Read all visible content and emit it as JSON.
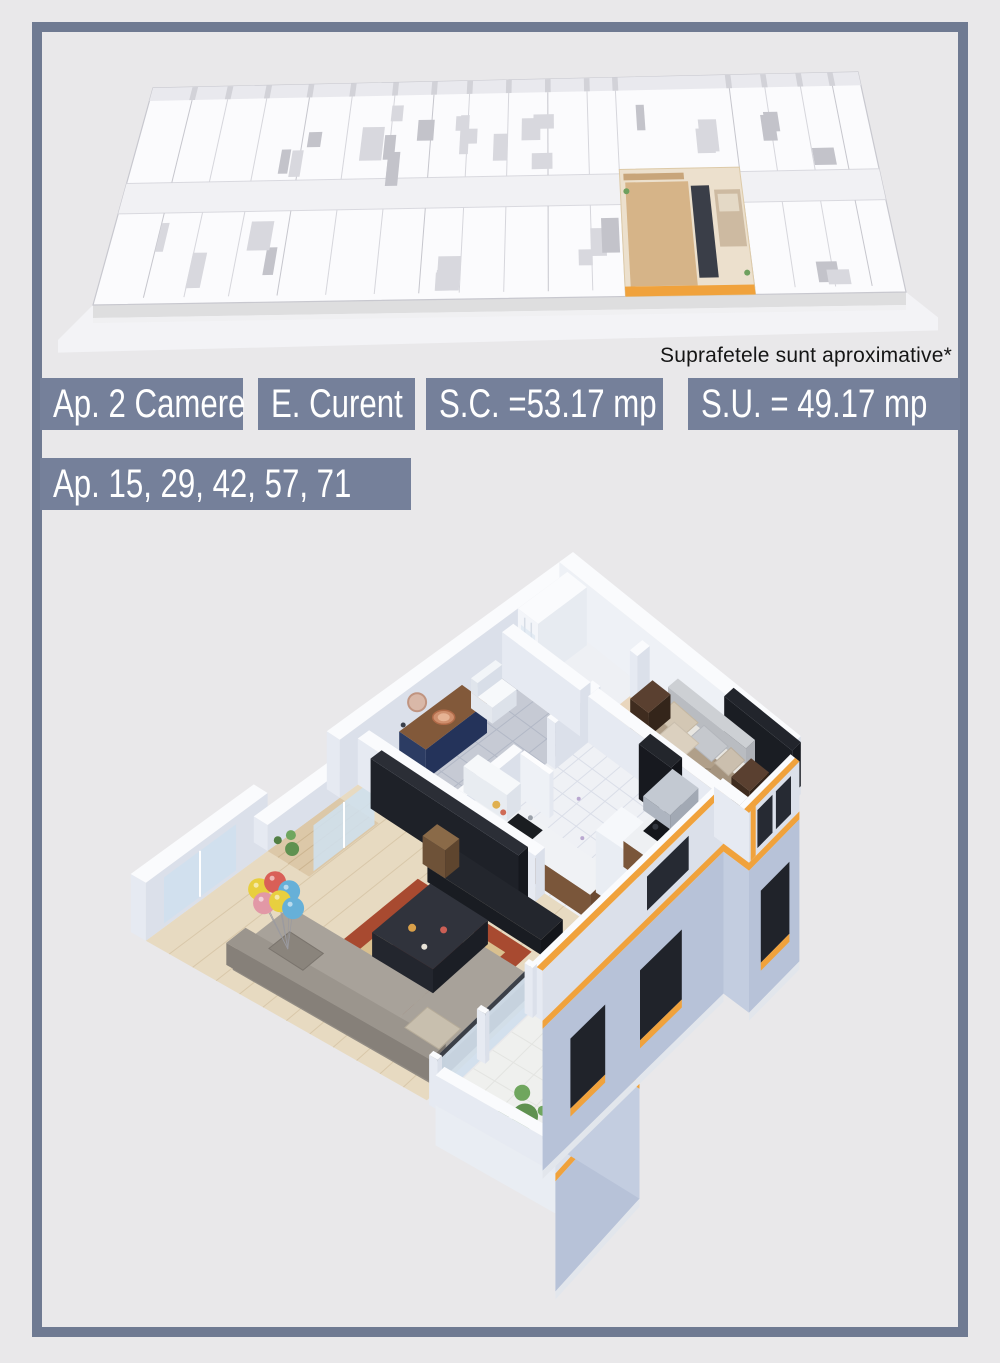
{
  "page": {
    "background": "#e9e8ea",
    "frame_color": "#6f7a92"
  },
  "note": {
    "text": "Suprafetele sunt aproximative*"
  },
  "badges": {
    "bg": "#75809a",
    "fg": "#ffffff",
    "row1": [
      {
        "name": "apartment-type",
        "text": "Ap. 2 Camere"
      },
      {
        "name": "stage",
        "text": "E. Curent"
      },
      {
        "name": "built-surface",
        "text": "S.C. =53.17 mp"
      },
      {
        "name": "usable-surface",
        "text": "S.U. = 49.17 mp"
      }
    ],
    "row2": [
      {
        "name": "apartment-numbers",
        "text": "Ap. 15, 29, 42, 57, 71"
      }
    ]
  },
  "illustrations": {
    "floor_overview": {
      "name": "floor-plan-overview",
      "description": "isometric 3d overview of whole floor, one apartment highlighted",
      "accent": "#f0a23c"
    },
    "apartment": {
      "name": "apartment-3d-cutaway",
      "description": "isometric 3d cutaway of the 2-room apartment",
      "accent": "#f0a23c",
      "facade": "#b7c2d8",
      "window_band": "#22252c"
    }
  }
}
